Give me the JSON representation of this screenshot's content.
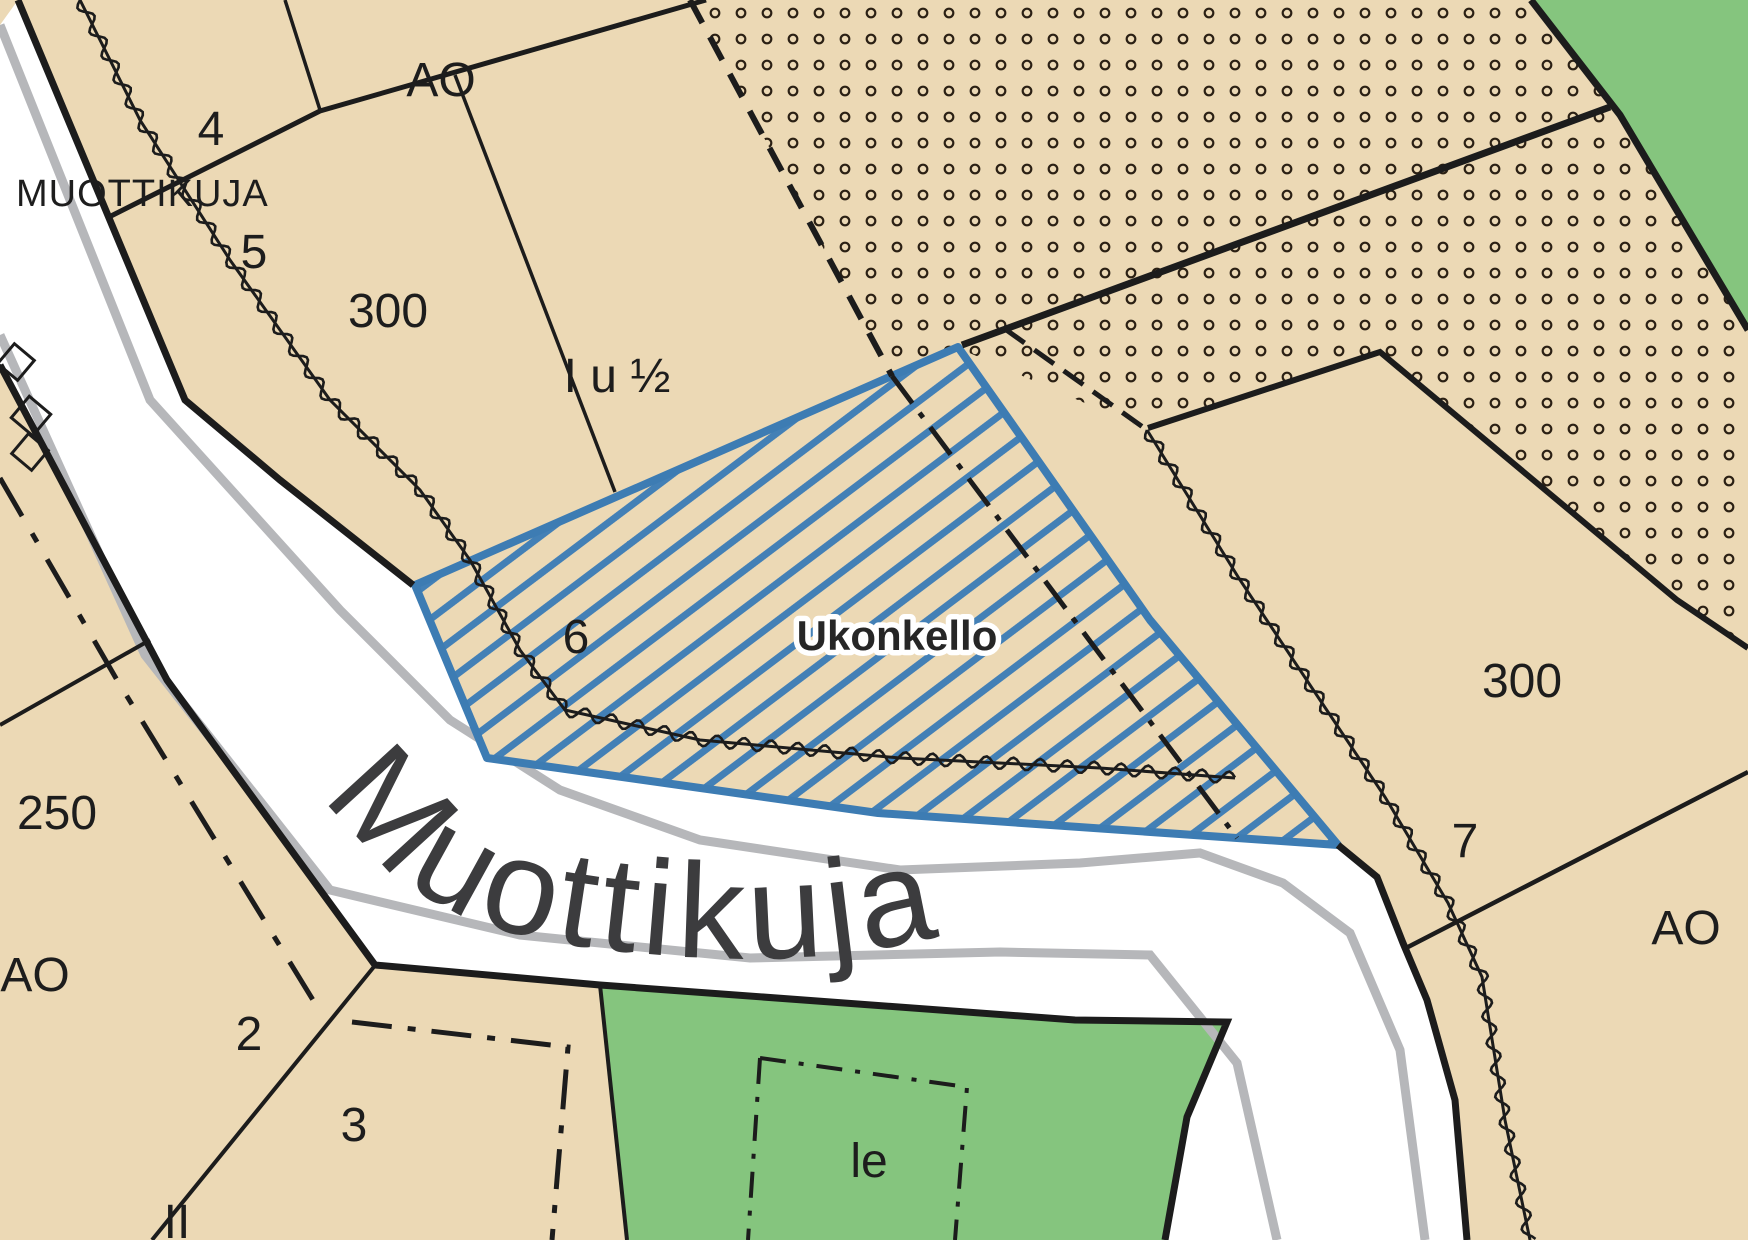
{
  "street": {
    "name_small": "MUOTTIKUJA",
    "name_large": "Muottikuja"
  },
  "selected_parcel": {
    "name": "Ukonkello",
    "number": "6"
  },
  "labels": {
    "lot_4": "4",
    "lot_5": "5",
    "lot_2": "2",
    "lot_3": "3",
    "lot_7": "7",
    "area_300_left": "300",
    "area_300_right": "300",
    "area_250": "250",
    "zone_ao_top": "AO",
    "zone_ao_left": "AO",
    "zone_ao_right": "AO",
    "floors_ratio": "I u ½",
    "floors_roman": "II",
    "play_area": "le"
  },
  "colors": {
    "parcel_fill": "#ecd9b5",
    "road_fill": "#ffffff",
    "green_area": "#85c57e",
    "selection_blue": "#3d7cb3",
    "plan_line": "#1c1c1c",
    "basemap_gray": "#b6b7ba"
  }
}
